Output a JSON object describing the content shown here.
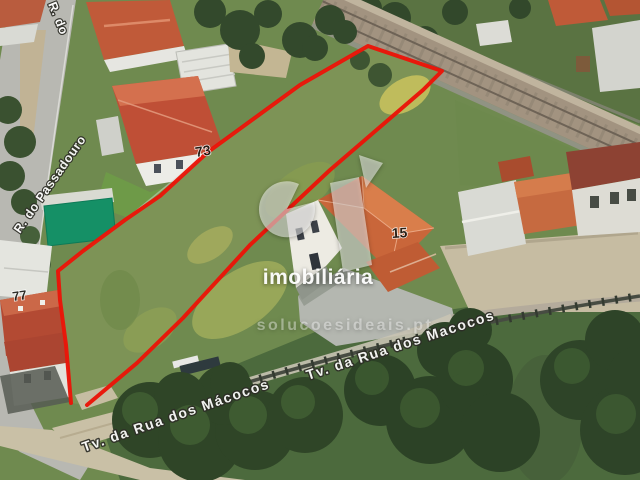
{
  "view": {
    "description": "3D aerial satellite photograph of an elongated land plot outlined in red, between residential houses and a railway line",
    "width": 640,
    "height": 480
  },
  "overlay": {
    "boundary_color": "#ea1508",
    "boundary_points": "71,403 66,345 60,300 58,271 83,251 125,220 160,196 208,152 300,85 368,46 442,71 423,90 330,170 250,245 183,318 137,363 87,405"
  },
  "streets": {
    "left_top_fragment": "R. do",
    "left": "R. do Passadouro",
    "bottom_left": "Tv. da Rua dos Mácocos",
    "bottom_right": "Tv. da Rua dos Macocos"
  },
  "house_numbers": {
    "left": "77",
    "middle": "73",
    "right": "15"
  },
  "watermark": {
    "logo": "si-logo",
    "brand": "imobiliária",
    "website": "solucoesideais.pt"
  },
  "palette": {
    "boundary_red": "#ea1508",
    "plot_grass": "#7d9356",
    "roof_terracotta": "#c45138",
    "roof_orange": "#c96a3f",
    "road_gray": "#b8b8b2",
    "dirt_tan": "#c9c0a6",
    "tree_green": "#2f4527",
    "pool_green": "#159066"
  }
}
